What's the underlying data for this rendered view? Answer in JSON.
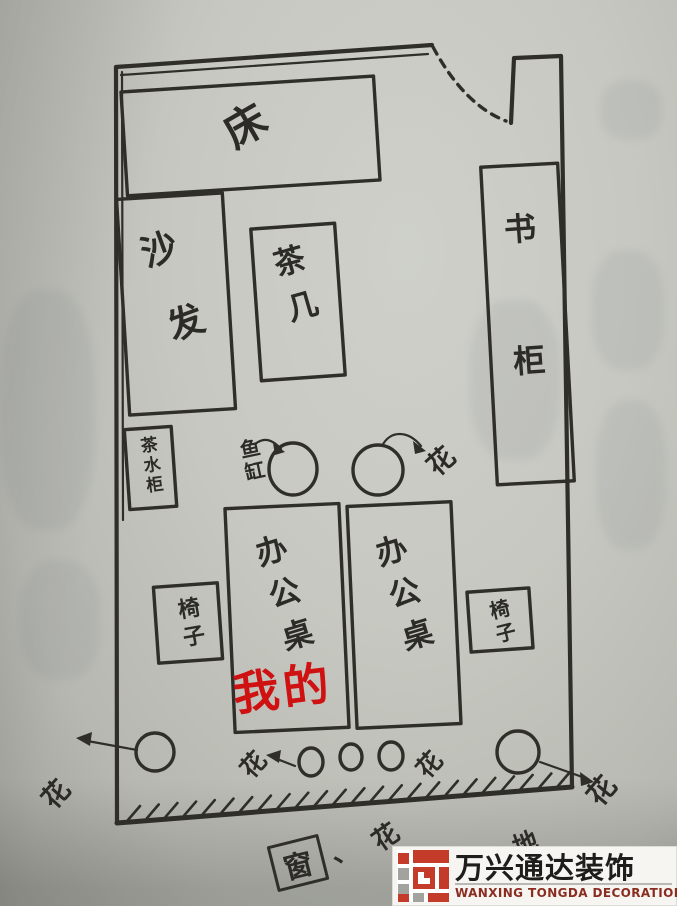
{
  "plan": {
    "bed": "床",
    "sofa": "沙发",
    "tea_table": "茶几",
    "tea_cabinet": "茶水柜",
    "bookcase": "书柜",
    "fish_tank": "鱼缸",
    "flower": "花",
    "desk": "办公桌",
    "my_desk_tag": "我的",
    "chair": "椅子",
    "window": "窗",
    "comma": "、",
    "floor_standing": "落地"
  },
  "colors": {
    "ink": "#2f2e29",
    "red_marker": "#cf1111",
    "paper": "#c7c8c1",
    "logo_red": "#c43b2a",
    "logo_gray": "#a2a29e"
  },
  "watermark": {
    "brand_cn": "万兴通达装饰",
    "brand_en": "WANXING TONGDA DECORATION"
  }
}
